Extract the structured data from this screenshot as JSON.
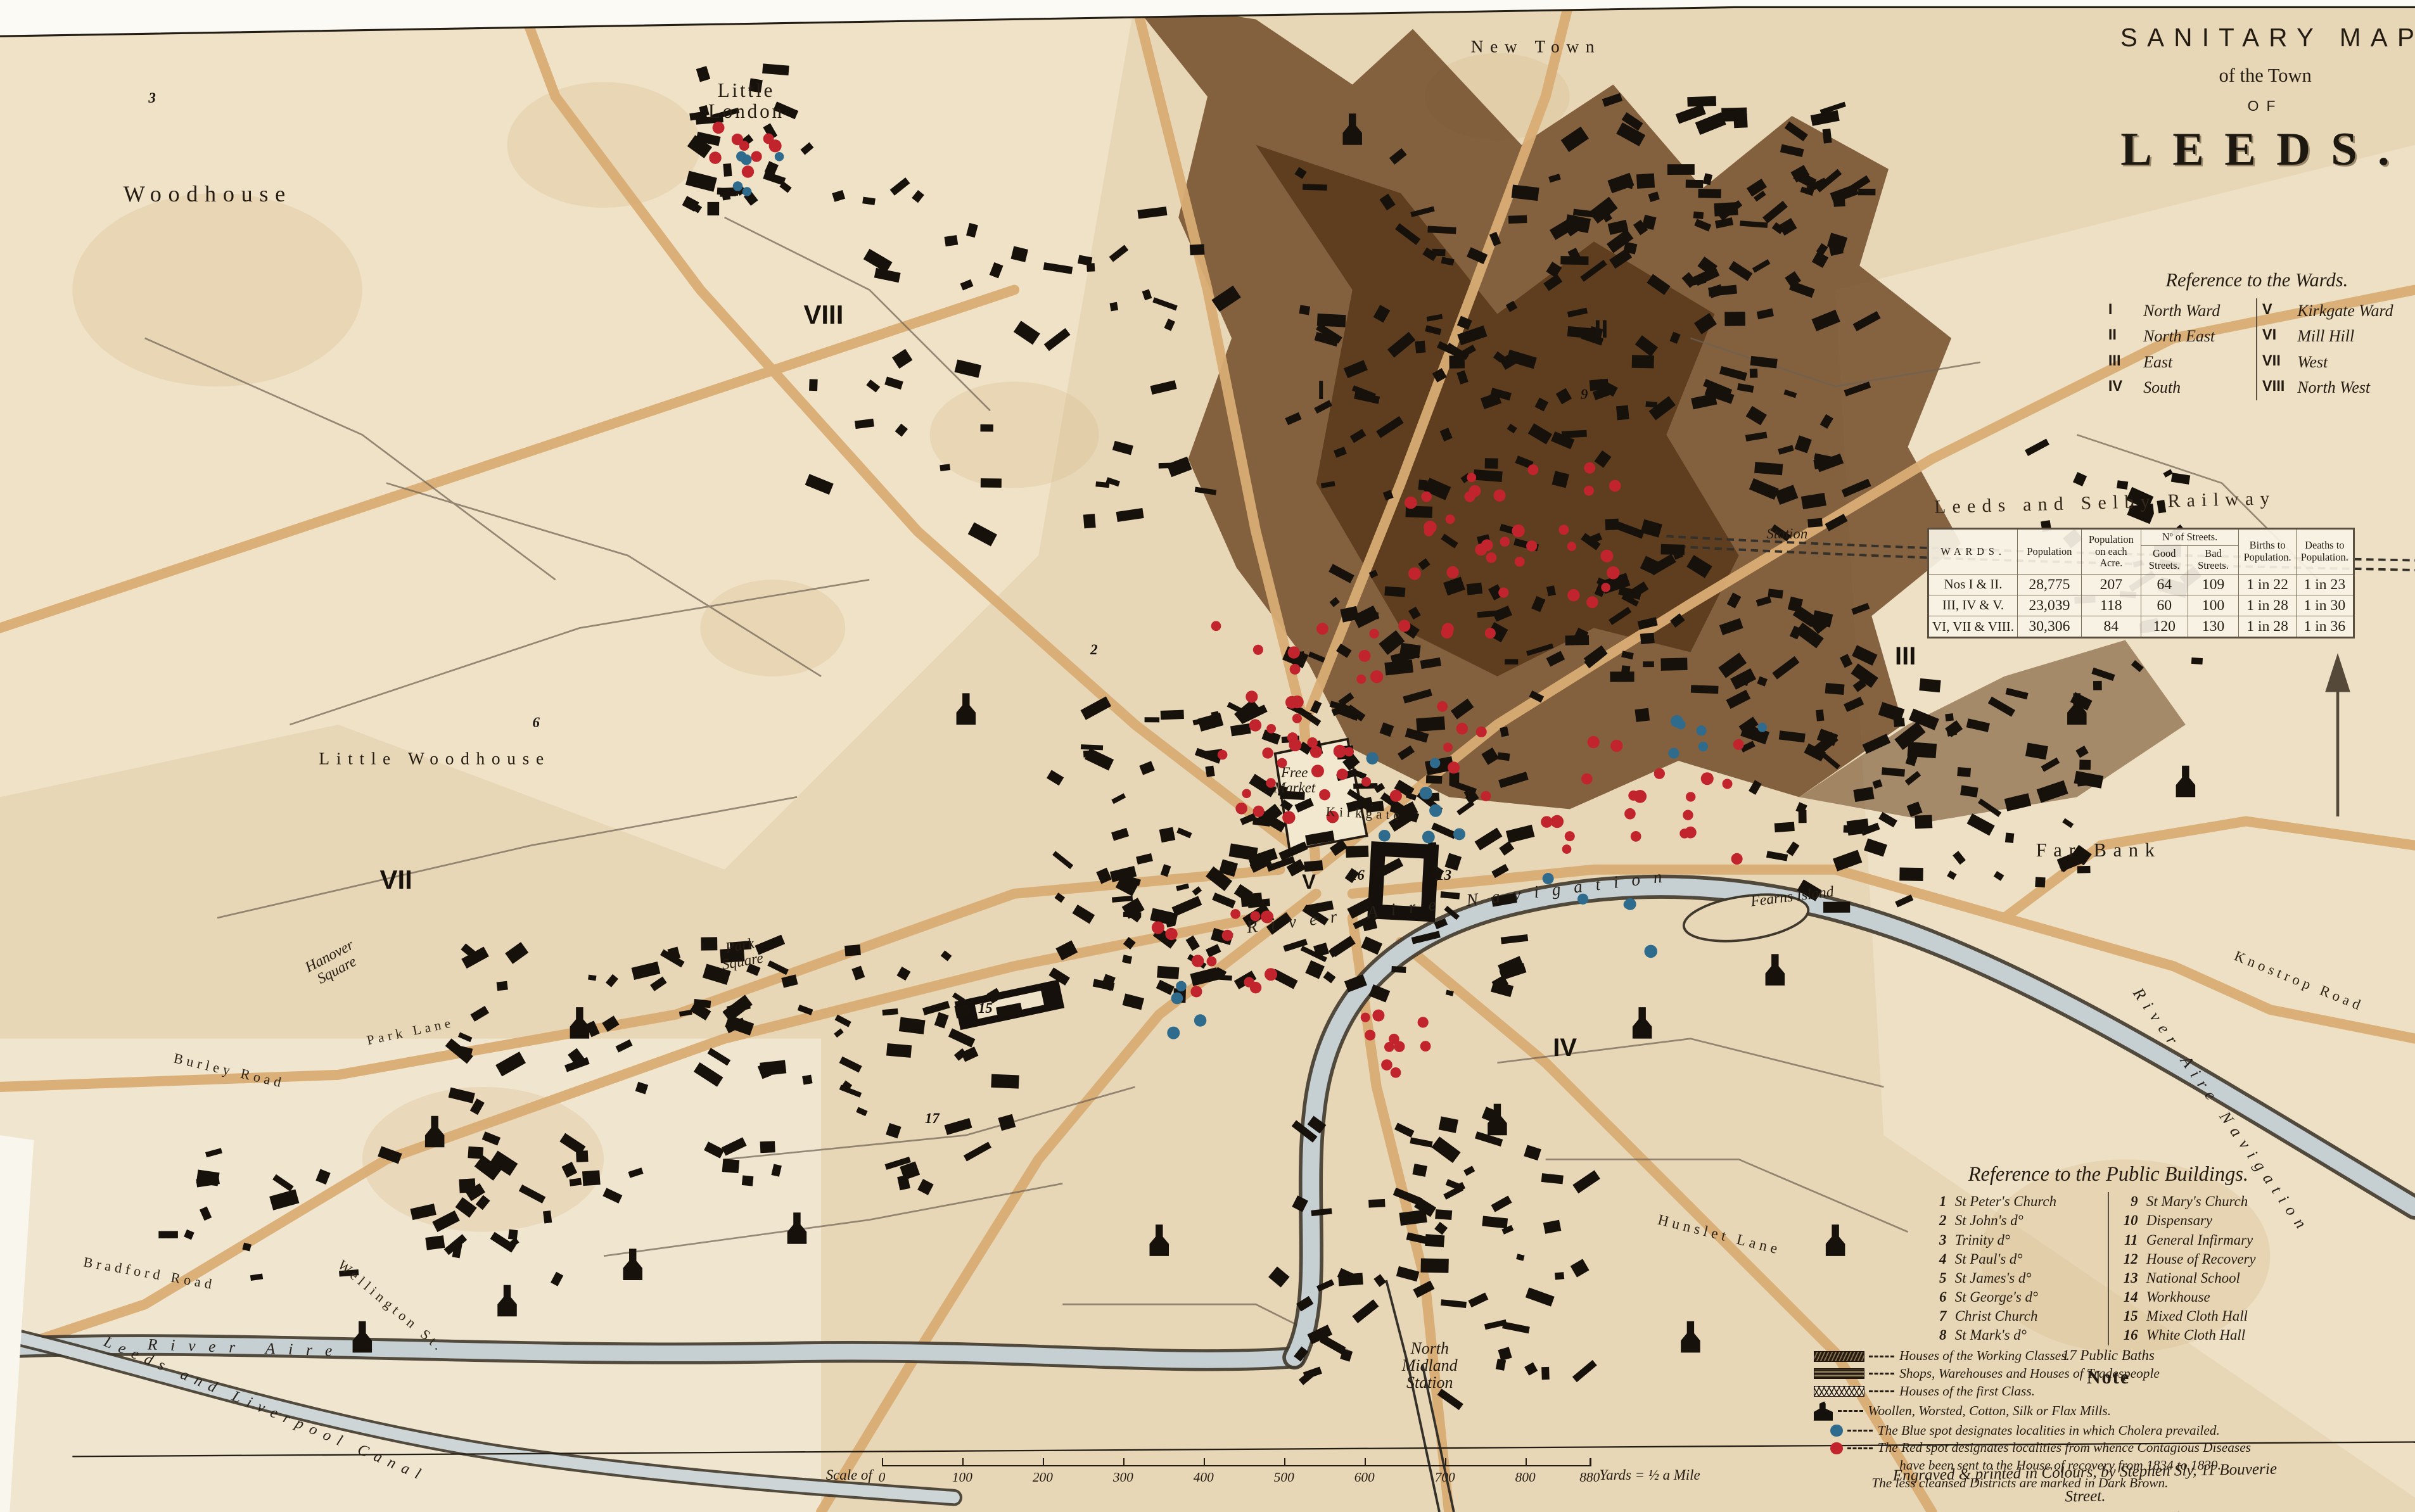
{
  "title": {
    "line1": "SANITARY MAP",
    "line2": "of the Town",
    "line3": "OF",
    "line4": "LEEDS."
  },
  "wards_reference": {
    "heading": "Reference to the Wards.",
    "left": [
      {
        "numeral": "I",
        "name": "North Ward"
      },
      {
        "numeral": "II",
        "name": "North East"
      },
      {
        "numeral": "III",
        "name": "East"
      },
      {
        "numeral": "IV",
        "name": "South"
      }
    ],
    "right": [
      {
        "numeral": "V",
        "name": "Kirkgate Ward"
      },
      {
        "numeral": "VI",
        "name": "Mill Hill"
      },
      {
        "numeral": "VII",
        "name": "West"
      },
      {
        "numeral": "VIII",
        "name": "North West"
      }
    ]
  },
  "railway_label": "Leeds and Selby Railway",
  "stats_table": {
    "headers": {
      "wards": "WARDS.",
      "population": "Population",
      "per_acre": "Population on each Acre.",
      "streets": "Nº of Streets.",
      "good": "Good Streets.",
      "bad": "Bad Streets.",
      "births": "Births to Population.",
      "deaths": "Deaths to Population."
    },
    "rows": [
      {
        "wards": "Nos I & II.",
        "population": "28,775",
        "per_acre": "207",
        "good": "64",
        "bad": "109",
        "births": "1 in 22",
        "deaths": "1 in 23"
      },
      {
        "wards": "III, IV & V.",
        "population": "23,039",
        "per_acre": "118",
        "good": "60",
        "bad": "100",
        "births": "1 in 28",
        "deaths": "1 in 30"
      },
      {
        "wards": "VI, VII & VIII.",
        "population": "30,306",
        "per_acre": "84",
        "good": "120",
        "bad": "130",
        "births": "1 in 28",
        "deaths": "1 in 36"
      }
    ]
  },
  "buildings_reference": {
    "heading": "Reference to the Public Buildings.",
    "left": [
      {
        "num": "1",
        "name": "St Peter's Church"
      },
      {
        "num": "2",
        "name": "St John's d°"
      },
      {
        "num": "3",
        "name": "Trinity d°"
      },
      {
        "num": "4",
        "name": "St Paul's d°"
      },
      {
        "num": "5",
        "name": "St James's d°"
      },
      {
        "num": "6",
        "name": "St George's d°"
      },
      {
        "num": "7",
        "name": "Christ Church"
      },
      {
        "num": "8",
        "name": "St Mark's d°"
      }
    ],
    "right": [
      {
        "num": "9",
        "name": "St Mary's Church"
      },
      {
        "num": "10",
        "name": "Dispensary"
      },
      {
        "num": "11",
        "name": "General Infirmary"
      },
      {
        "num": "12",
        "name": "House of Recovery"
      },
      {
        "num": "13",
        "name": "National School"
      },
      {
        "num": "14",
        "name": "Workhouse"
      },
      {
        "num": "15",
        "name": "Mixed Cloth Hall"
      },
      {
        "num": "16",
        "name": "White Cloth Hall"
      }
    ],
    "extra": {
      "num": "17",
      "name": "Public Baths"
    },
    "note_heading": "Note"
  },
  "legend": {
    "working": "Houses of the Working Classes.",
    "shops": "Shops, Warehouses and Houses of Tradespeople",
    "first_class": "Houses of the first Class.",
    "mills": "Woollen, Worsted, Cotton, Silk or Flax Mills.",
    "blue": "The Blue spot designates localities in which Cholera prevailed.",
    "red1": "The Red spot designates localities from whence Contagious Diseases",
    "red2": "have been sent to the House of recovery from 1834 to 1839.",
    "brown": "The less cleansed Districts are marked in Dark Brown."
  },
  "attribution": {
    "line1": "Engraved & printed in Colours, by Stephen Sly, 11 Bouverie Street.",
    "line2": "For her Majesty's Stationery Office."
  },
  "scale_bar": {
    "prefix": "Scale of",
    "ticks": [
      "0",
      "100",
      "200",
      "300",
      "400",
      "500",
      "600",
      "700",
      "800",
      "880"
    ],
    "suffix": "Yards = ½ a Mile"
  },
  "map_labels": [
    {
      "name": "label-woodhouse",
      "text": "Woodhouse",
      "x": 8.6,
      "y": 12.8,
      "rot": 0,
      "size": 0.95,
      "cls": "place"
    },
    {
      "name": "label-little-london",
      "text": "Little\nLondon",
      "x": 30.9,
      "y": 6.7,
      "rot": 0,
      "size": 0.82,
      "cls": "place-2l"
    },
    {
      "name": "label-new-town",
      "text": "New Town",
      "x": 63.6,
      "y": 3.1,
      "rot": 0,
      "size": 0.72,
      "cls": "place"
    },
    {
      "name": "label-little-woodhouse",
      "text": "Little Woodhouse",
      "x": 18.0,
      "y": 50.2,
      "rot": 0,
      "size": 0.72,
      "cls": "place"
    },
    {
      "name": "label-hanover-square",
      "text": "Hanover\nSquare",
      "x": 13.8,
      "y": 63.7,
      "rot": -28,
      "size": 0.62,
      "cls": "place-italic-2l"
    },
    {
      "name": "label-park-square",
      "text": "Park\nSquare",
      "x": 30.7,
      "y": 63.1,
      "rot": -10,
      "size": 0.62,
      "cls": "place-italic-2l"
    },
    {
      "name": "label-free-market",
      "text": "Free\nMarket",
      "x": 53.6,
      "y": 51.6,
      "rot": 0,
      "size": 0.6,
      "cls": "place-italic-2l"
    },
    {
      "name": "label-far-bank",
      "text": "Far Bank",
      "x": 86.9,
      "y": 56.2,
      "rot": 0,
      "size": 0.8,
      "cls": "place"
    },
    {
      "name": "label-fearns-island",
      "text": "Fearns Island",
      "x": 74.2,
      "y": 59.3,
      "rot": -7,
      "size": 0.62,
      "cls": "place-italic"
    },
    {
      "name": "label-north-midland-station",
      "text": "North\nMidland\nStation",
      "x": 59.2,
      "y": 90.3,
      "rot": 0,
      "size": 0.68,
      "cls": "place-italic-2l"
    },
    {
      "name": "label-station",
      "text": "Station",
      "x": 74.0,
      "y": 35.3,
      "rot": 0,
      "size": 0.6,
      "cls": "place-italic"
    },
    {
      "name": "label-hunslet-lane",
      "text": "Hunslet Lane",
      "x": 71.2,
      "y": 81.7,
      "rot": 14,
      "size": 0.62,
      "cls": "street"
    },
    {
      "name": "label-knostrop-road",
      "text": "Knostrop Road",
      "x": 95.2,
      "y": 64.9,
      "rot": 22,
      "size": 0.6,
      "cls": "street"
    },
    {
      "name": "label-burley-road",
      "text": "Burley Road",
      "x": 9.5,
      "y": 70.8,
      "rot": 13,
      "size": 0.58,
      "cls": "street"
    },
    {
      "name": "label-bradford-road",
      "text": "Bradford Road",
      "x": 6.2,
      "y": 84.2,
      "rot": 10,
      "size": 0.58,
      "cls": "street"
    },
    {
      "name": "label-wellington-street",
      "text": "Wellington St.",
      "x": 16.2,
      "y": 86.4,
      "rot": 40,
      "size": 0.58,
      "cls": "street"
    },
    {
      "name": "label-park-lane",
      "text": "Park Lane",
      "x": 17.0,
      "y": 68.2,
      "rot": -12,
      "size": 0.55,
      "cls": "street"
    },
    {
      "name": "label-kirkgate",
      "text": "Kirkgate",
      "x": 56.5,
      "y": 53.8,
      "rot": 3,
      "size": 0.55,
      "cls": "street"
    },
    {
      "name": "label-river-aire-navigation-mid",
      "text": "River Aire Navigation",
      "x": 60.5,
      "y": 59.6,
      "rot": -7,
      "size": 0.72,
      "cls": "water-wide"
    },
    {
      "name": "label-river-aire-navigation-right",
      "text": "River Aire Navigation",
      "x": 92.0,
      "y": 73.5,
      "rot": 55,
      "size": 0.68,
      "cls": "water"
    },
    {
      "name": "label-river-aire",
      "text": "River Aire",
      "x": 10.2,
      "y": 89.2,
      "rot": 2,
      "size": 0.66,
      "cls": "water-wide"
    },
    {
      "name": "label-leeds-liverpool-canal",
      "text": "Leeds and Liverpool Canal",
      "x": 11.0,
      "y": 93.2,
      "rot": 23,
      "size": 0.64,
      "cls": "water"
    },
    {
      "name": "ward-numeral-i",
      "text": "I",
      "x": 54.7,
      "y": 25.8,
      "rot": 0,
      "size": 1.1,
      "cls": "numeral"
    },
    {
      "name": "ward-numeral-ii",
      "text": "II",
      "x": 66.3,
      "y": 21.8,
      "rot": 0,
      "size": 1.05,
      "cls": "numeral"
    },
    {
      "name": "ward-numeral-iii",
      "text": "III",
      "x": 78.9,
      "y": 43.4,
      "rot": 0,
      "size": 1.05,
      "cls": "numeral"
    },
    {
      "name": "ward-numeral-iv",
      "text": "IV",
      "x": 64.8,
      "y": 69.3,
      "rot": 0,
      "size": 1.05,
      "cls": "numeral"
    },
    {
      "name": "ward-numeral-v",
      "text": "V",
      "x": 54.2,
      "y": 58.3,
      "rot": 0,
      "size": 0.85,
      "cls": "numeral"
    },
    {
      "name": "ward-numeral-vii",
      "text": "VII",
      "x": 16.4,
      "y": 58.2,
      "rot": 0,
      "size": 1.1,
      "cls": "numeral"
    },
    {
      "name": "ward-numeral-viii",
      "text": "VIII",
      "x": 34.1,
      "y": 20.8,
      "rot": 0,
      "size": 1.1,
      "cls": "numeral"
    },
    {
      "name": "building-number-2",
      "text": "2",
      "x": 45.3,
      "y": 43.0,
      "rot": 0,
      "size": 0.6,
      "cls": "bnum"
    },
    {
      "name": "building-number-3",
      "text": "3",
      "x": 6.3,
      "y": 6.5,
      "rot": 0,
      "size": 0.6,
      "cls": "bnum"
    },
    {
      "name": "building-number-6",
      "text": "6",
      "x": 22.2,
      "y": 47.8,
      "rot": 0,
      "size": 0.6,
      "cls": "bnum"
    },
    {
      "name": "building-number-9",
      "text": "9",
      "x": 65.6,
      "y": 26.1,
      "rot": 0,
      "size": 0.6,
      "cls": "bnum"
    },
    {
      "name": "building-number-13",
      "text": "13",
      "x": 59.8,
      "y": 57.9,
      "rot": 0,
      "size": 0.6,
      "cls": "bnum"
    },
    {
      "name": "building-number-15",
      "text": "15",
      "x": 40.8,
      "y": 66.7,
      "rot": 0,
      "size": 0.6,
      "cls": "bnum"
    },
    {
      "name": "building-number-16",
      "text": "16",
      "x": 56.2,
      "y": 57.9,
      "rot": 0,
      "size": 0.6,
      "cls": "bnum"
    },
    {
      "name": "building-number-17",
      "text": "17",
      "x": 38.6,
      "y": 74.0,
      "rot": 0,
      "size": 0.6,
      "cls": "bnum"
    }
  ],
  "colors": {
    "parchment": "#e7d7b6",
    "district_brown": "#6a4421",
    "district_dark": "#4e2f12",
    "road_tan": "#d9ad74",
    "river": "#c6d0d3",
    "building_ink": "#17110c",
    "cholera_blue": "#2f6b8c",
    "disease_red": "#c2242d",
    "ink": "#241c12"
  }
}
